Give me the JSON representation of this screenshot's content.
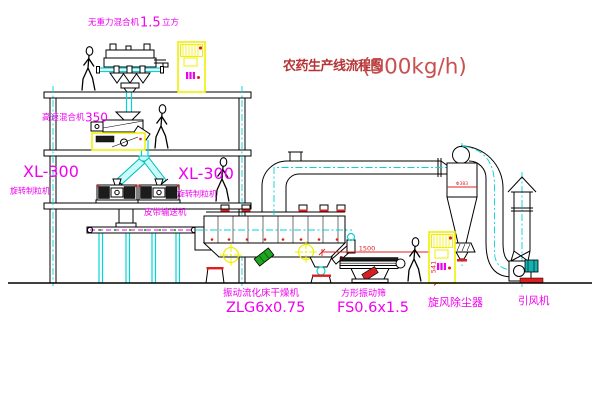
{
  "title": {
    "main": "农药生产线流程图",
    "capacity": "(500kg/h)"
  },
  "equipment": {
    "gravity_mixer": {
      "name": "无重力混合机",
      "value": "1.5",
      "unit": "立方"
    },
    "hs_mixer": {
      "name": "高速混合机",
      "value": "350"
    },
    "granulators": [
      {
        "model": "XL-300",
        "name": "旋转制粒机"
      },
      {
        "model": "XL-300",
        "name": "旋转制粒机"
      }
    ],
    "conveyor": {
      "name": "皮带输送机"
    },
    "dryer": {
      "name": "振动流化床干燥机",
      "model": "ZLG6x0.75"
    },
    "sieve": {
      "name": "方形振动筛",
      "model": "FS0.6x1.5"
    },
    "cyclone": {
      "name": "旋风除尘器",
      "note": "Φ383"
    },
    "fan": {
      "name": "引风机"
    }
  },
  "dimensions": {
    "sieve_length": "1500",
    "sieve_height": "541"
  },
  "colors": {
    "label_magenta": "#f000f0",
    "title_red": "#b53535",
    "pipe_cyan": "#00d4d4",
    "highlight_yellow": "#f0f000",
    "accent_red": "#df1f1f",
    "motor_teal": "#17b0b0",
    "cylinder_green": "#1fa51f",
    "line_black": "#000000"
  }
}
